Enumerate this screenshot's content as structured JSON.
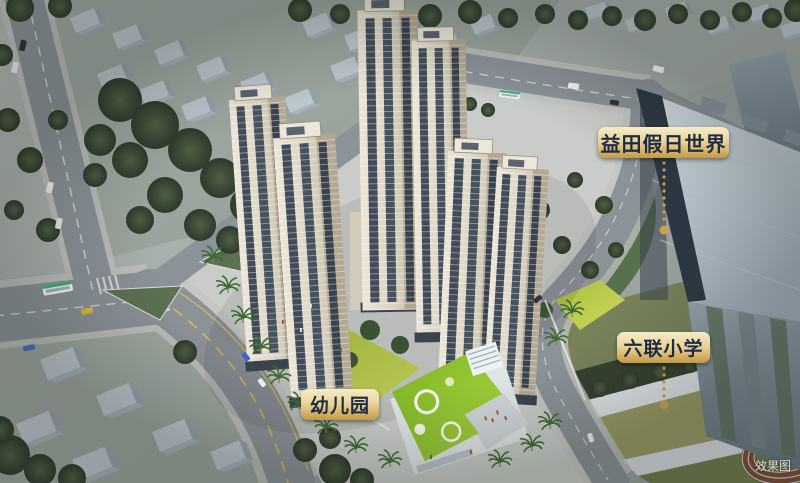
{
  "scene": {
    "watermark": "效果图"
  },
  "annotations": {
    "mall": "益田假日世界",
    "school": "六联小学",
    "kindergarten": "幼儿园"
  },
  "colors": {
    "label_gold_light": "#f7ecc6",
    "label_gold_mid": "#e8d296",
    "label_gold_dark": "#c49a43",
    "label_text": "#1d2b45",
    "leader_gold": "#cfa64f"
  }
}
